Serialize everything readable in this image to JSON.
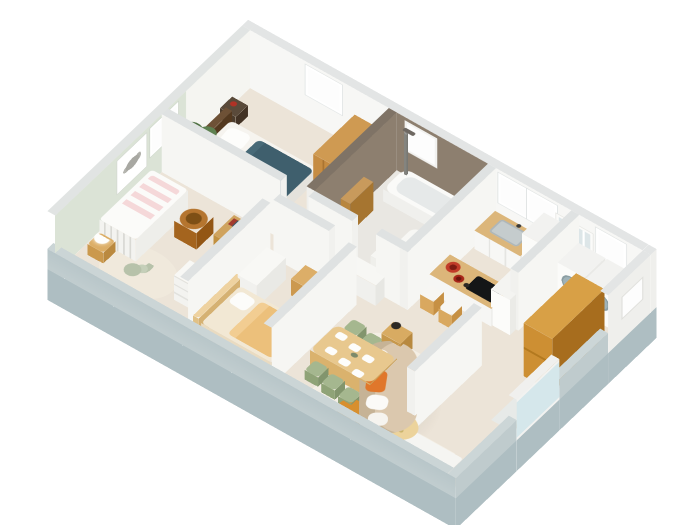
{
  "title": "3D isometric cutaway floor plan rendering of an apartment",
  "view": {
    "projection": "isometric dollhouse cutaway, viewed from south corner",
    "background": "#ffffff",
    "full_height_walls": "north-west and north-east exterior walls",
    "cut_low_walls": "south-west and south-east exterior walls"
  },
  "palette": {
    "floor": "#ece4d8",
    "wall_white": "#f6f6f3",
    "wall_cap": "#dfe2e2",
    "nursery_mint_wall": "#dbe3d6",
    "bathroom_taupe_wall": "#8d7f6f",
    "exterior_low_wall": "#b4c2c5",
    "wood_orange": "#c98a3a",
    "wood_light": "#dcb67a",
    "teal_blanket": "#3f5f6d",
    "tan_blanket": "#ecc07b",
    "sofa_beige": "#dbc8ae",
    "accent_orange": "#d78f2e",
    "chair_green": "#a5b78f",
    "entry_glass": "#d5e7eb",
    "red_bowl": "#c13b28"
  },
  "exterior": {
    "windows_count": 7,
    "glass_entry_door_count": 1
  },
  "rooms": [
    {
      "name": "master-bedroom",
      "furniture": [
        "double-bed",
        "teal-blanket",
        "white-pillows",
        "dark-headboard",
        "nightstand",
        "wood-wardrobe",
        "plant",
        "dark-chair"
      ]
    },
    {
      "name": "bathroom",
      "wall_color": "#8d7f6f",
      "furniture": [
        "bathtub",
        "shower-column",
        "towel-ladder",
        "white-vanity",
        "bath-mat"
      ]
    },
    {
      "name": "kitchen",
      "furniture": [
        "sink-counter",
        "glass-wall-cabinet",
        "fridge",
        "island-with-cooktop",
        "three-bar-stools",
        "red-fruit-bowls",
        "pantry-column"
      ]
    },
    {
      "name": "laundry",
      "furniture": [
        "washing-machine",
        "dryer",
        "wooden-wardrobe"
      ]
    },
    {
      "name": "entry",
      "furniture": [
        "glass-entry-door"
      ]
    },
    {
      "name": "nursery",
      "wall_color": "#dbe3d6",
      "furniture": [
        "crib-with-pink-bedding",
        "rabbit-wall-art",
        "wicker-basket",
        "stool-with-ball-lamp",
        "book-shelf",
        "white-dresser",
        "round-rug",
        "plush-bunny"
      ]
    },
    {
      "name": "second-bedroom",
      "furniture": [
        "bed-with-tan-blanket",
        "curved-wood-headboard",
        "desk",
        "wood-chair",
        "white-dresser"
      ]
    },
    {
      "name": "dining-area",
      "furniture": [
        "wood-dining-table",
        "six-green-chairs",
        "white-place-settings"
      ]
    },
    {
      "name": "living-room",
      "furniture": [
        "curved-beige-sofa",
        "orange-cushion",
        "kidney-coffee-table",
        "orange-round-table",
        "side-table-with-lamp",
        "white-tv-bench",
        "speaker",
        "cream-area-rug"
      ]
    }
  ]
}
